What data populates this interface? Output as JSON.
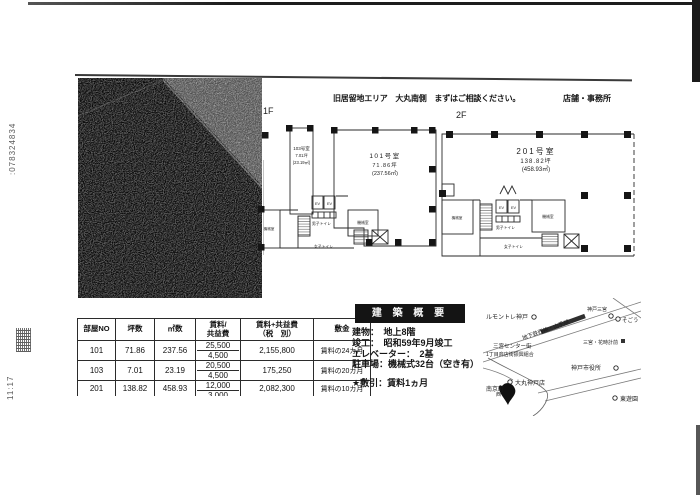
{
  "scan": {
    "fax_number": ":078324834",
    "fax_time": "11:17"
  },
  "header": {
    "title": "旧居留地エリア　大丸南側　まずはご相談ください。",
    "category": "店舗・事務所"
  },
  "floor1": {
    "label": "1F",
    "room103": {
      "name": "103号室",
      "tsubo": "7.01坪",
      "sqm": "(23.19㎡)"
    },
    "room101": {
      "name": "101号室",
      "tsubo": "71.86坪",
      "sqm": "(237.56㎡)"
    }
  },
  "floor2": {
    "label": "2F",
    "room201": {
      "name": "201号室",
      "tsubo": "138.82坪",
      "sqm": "(458.93㎡)"
    }
  },
  "plan": {
    "ev": "EV",
    "mens_toilet": "男子トイレ",
    "womens_toilet": "女子トイレ",
    "machine_room": "機械室"
  },
  "table": {
    "headers": {
      "room_no": "部屋NO",
      "tsubo": "坪数",
      "sqm": "㎡数",
      "rent1": "賃料/",
      "rent2": "共益費",
      "total1": "賃料+共益費",
      "total2": "（税　別）",
      "deposit": "敷金"
    },
    "rows": [
      {
        "no": "101",
        "tsubo": "71.86",
        "sqm": "237.56",
        "rent": "25,500",
        "fee": "4,500",
        "total": "2,155,800",
        "deposit": "賃料の24カ月"
      },
      {
        "no": "103",
        "tsubo": "7.01",
        "sqm": "23.19",
        "rent": "20,500",
        "fee": "4,500",
        "total": "175,250",
        "deposit": "賃料の20カ月"
      },
      {
        "no": "201",
        "tsubo": "138.82",
        "sqm": "458.93",
        "rent": "12,000",
        "fee": "3,000",
        "total": "2,082,300",
        "deposit": "賃料の10カ月"
      }
    ]
  },
  "overview": {
    "title": "建 築 概 要",
    "building": "建物：　地上8階",
    "completion": "竣工：　昭和59年9月竣工",
    "elevator": "エレベーター：　2基",
    "parking": "駐車場：機械式32台（空き有）",
    "note": "★敷引：賃料1ヵ月"
  },
  "map": {
    "hotel": "ルモントレ神戸",
    "subway": "地下鉄西神・山手線",
    "street1": "三宮センター街",
    "street2": "1丁目商店街振興組合",
    "sannomiya": "神戸三宮",
    "sogo": "そごう",
    "hanadokei": "三宮・花時計前",
    "city_hall": "神戸市役所",
    "daimaru": "大丸神戸店",
    "nankinmachi": "南京町",
    "nishi": "西",
    "park": "東遊園"
  }
}
